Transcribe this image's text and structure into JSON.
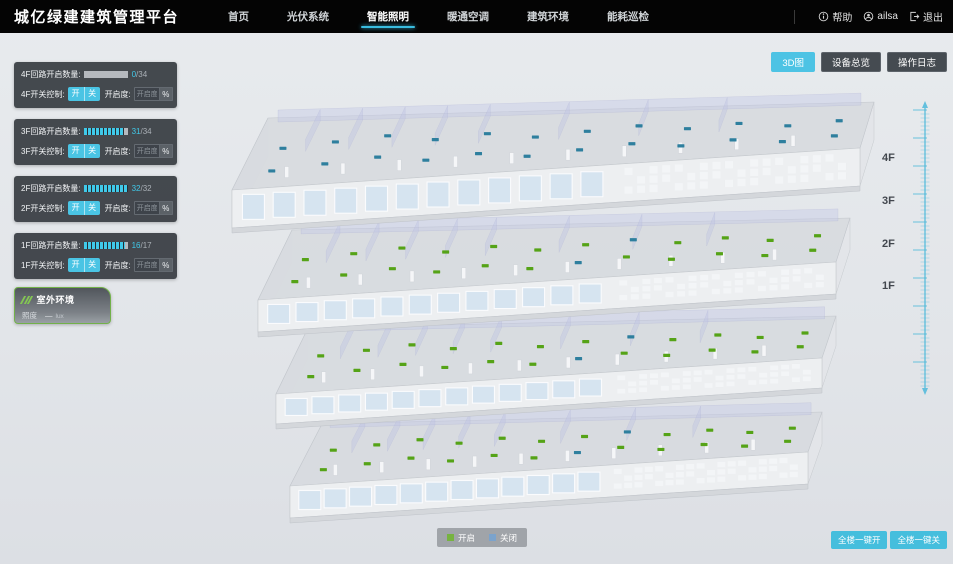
{
  "header": {
    "brand": "城亿绿建建筑管理平台",
    "nav": [
      {
        "label": "首页",
        "active": false
      },
      {
        "label": "光伏系统",
        "active": false
      },
      {
        "label": "智能照明",
        "active": true
      },
      {
        "label": "暖通空调",
        "active": false
      },
      {
        "label": "建筑环境",
        "active": false
      },
      {
        "label": "能耗巡检",
        "active": false
      }
    ],
    "help_label": "帮助",
    "user_name": "ailsa",
    "logout_label": "退出"
  },
  "view_buttons": [
    {
      "label": "3D图",
      "active": true
    },
    {
      "label": "设备总览",
      "active": false
    },
    {
      "label": "操作日志",
      "active": false
    }
  ],
  "panel_labels": {
    "on": "开",
    "off": "关",
    "dim_label": "开启度:",
    "dim_placeholder": "开启度",
    "percent": "%"
  },
  "floor_panels": [
    {
      "count_label": "4F回路开启数量:",
      "open": 0,
      "total": 34,
      "count_open": "0",
      "count_rest": "/34",
      "switch_label": "4F开关控制:"
    },
    {
      "count_label": "3F回路开启数量:",
      "open": 31,
      "total": 34,
      "count_open": "31",
      "count_rest": "/34",
      "switch_label": "3F开关控制:"
    },
    {
      "count_label": "2F回路开启数量:",
      "open": 32,
      "total": 32,
      "count_open": "32",
      "count_rest": "/32",
      "switch_label": "2F开关控制:"
    },
    {
      "count_label": "1F回路开启数量:",
      "open": 16,
      "total": 17,
      "count_open": "16",
      "count_rest": "/17",
      "switch_label": "1F开关控制:"
    }
  ],
  "outdoor": {
    "title": "室外环境",
    "metric_label": "照度",
    "metric_value": "—",
    "metric_unit": "lux"
  },
  "legend": {
    "on_label": "开启",
    "on_color": "#76b340",
    "off_label": "关闭",
    "off_color": "#7ba3cc"
  },
  "bulk_buttons": [
    {
      "label": "全楼一键开"
    },
    {
      "label": "全楼一键关"
    }
  ],
  "floor_markers": [
    "4F",
    "3F",
    "2F",
    "1F"
  ],
  "scene": {
    "on_color": "#55a317",
    "off_color": "#2e7f9e",
    "floors": [
      {
        "label": "4F",
        "state": "closed"
      },
      {
        "label": "3F",
        "state": "open"
      },
      {
        "label": "2F",
        "state": "open"
      },
      {
        "label": "1F",
        "state": "open"
      }
    ]
  }
}
